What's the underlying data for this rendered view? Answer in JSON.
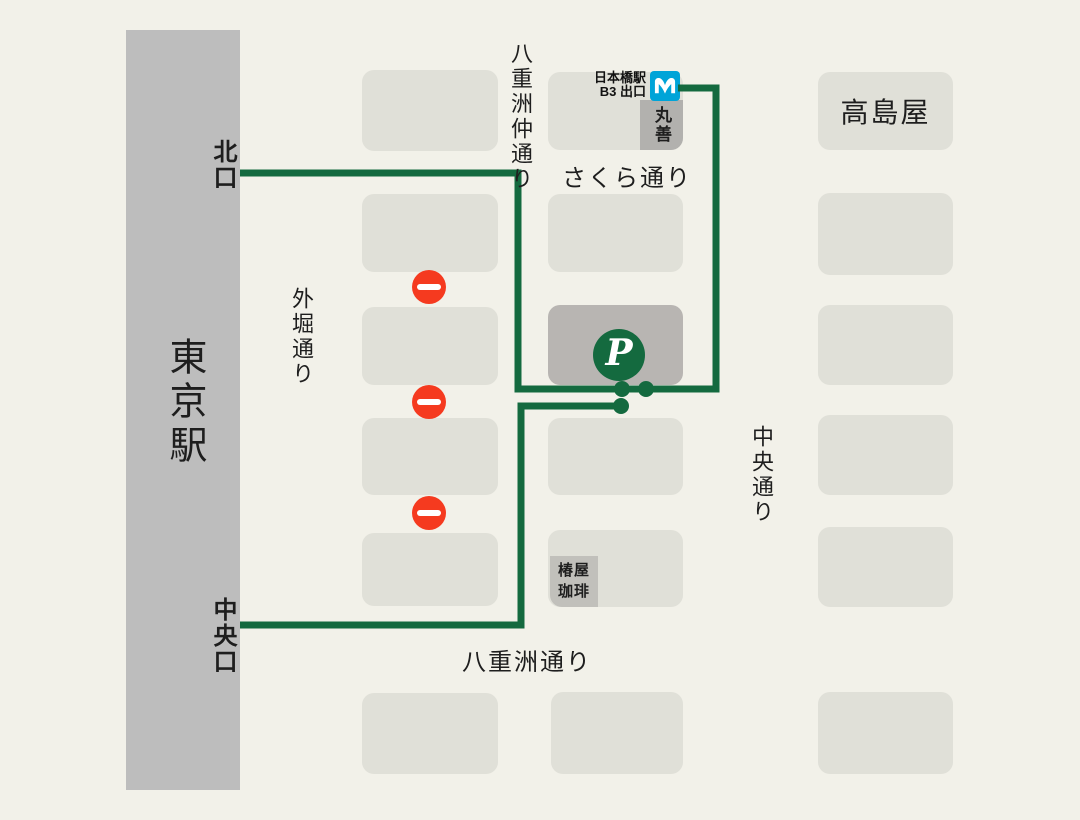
{
  "colors": {
    "bg": "#F2F1E9",
    "block": "#E0E0D8",
    "station": "#BDBDBD",
    "parking_block": "#B8B5B2",
    "label_box": "#B2B1AE",
    "tsubakiya_box": "#C1C0BB",
    "green": "#146A3F",
    "red": "#F53A1F",
    "blue": "#00A4D8",
    "text": "#1E1E1E"
  },
  "station": {
    "name": "東京駅",
    "north_exit": "北口",
    "central_exit": "中央口"
  },
  "streets": {
    "yaesu_naka": "八重洲仲通り",
    "sotobori": "外堀通り",
    "sakura": "さくら通り",
    "chuo": "中央通り",
    "yaesu": "八重洲通り"
  },
  "landmarks": {
    "takashimaya": "高島屋",
    "maruzen": "丸善",
    "tsubakiya_line1": "椿屋",
    "tsubakiya_line2": "珈琲",
    "metro_exit_line1": "日本橋駅",
    "metro_exit_line2": "B3 出口",
    "metro_icon_name": "tokyo-metro-icon"
  },
  "parking": {
    "label": "P"
  },
  "no_entry_signs": {
    "count": 3
  }
}
